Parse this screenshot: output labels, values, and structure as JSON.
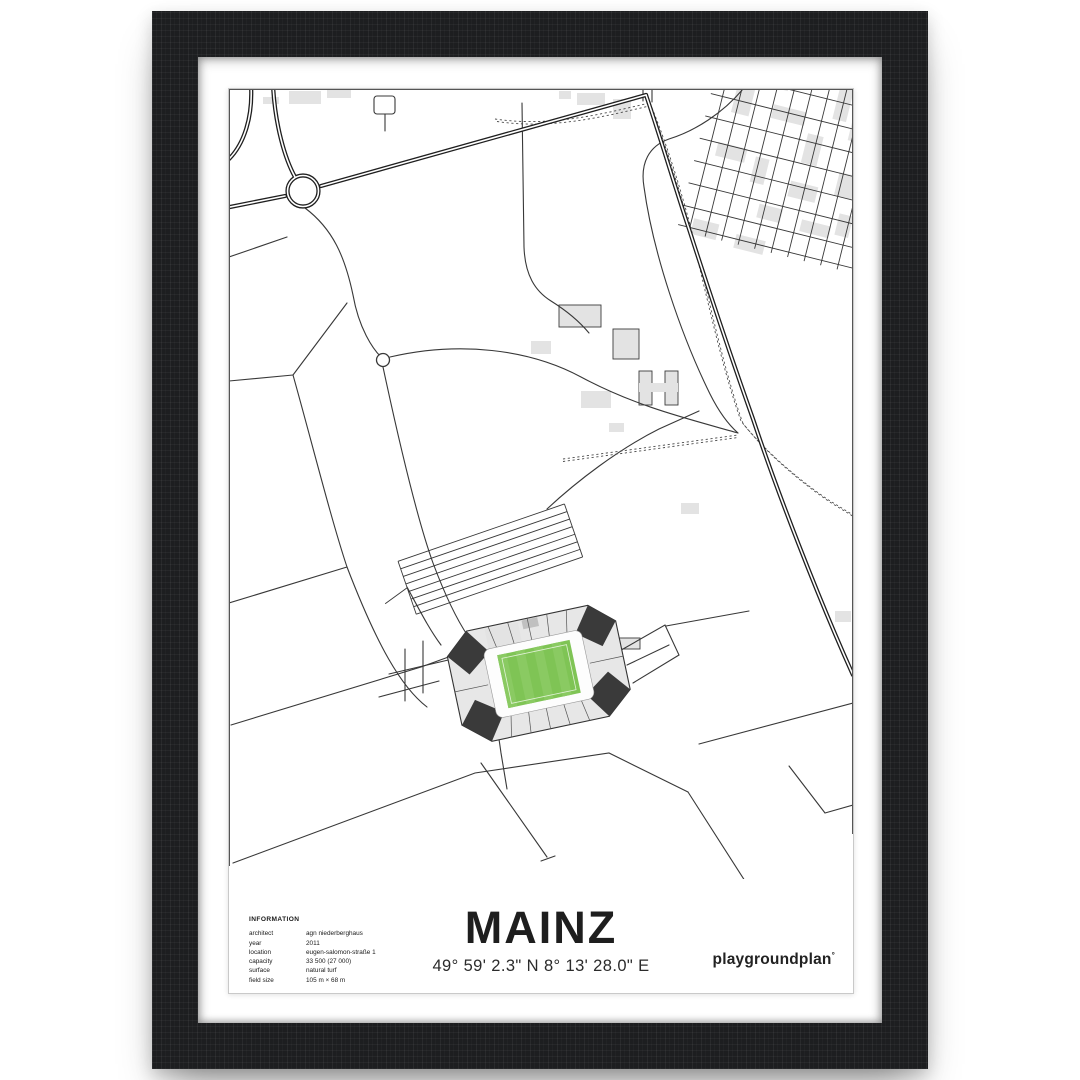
{
  "poster": {
    "title": "MAINZ",
    "coordinates": "49° 59' 2.3\" N  8° 13' 28.0\" E",
    "brand": "playgroundplan",
    "brand_mark": "°"
  },
  "info": {
    "header": "INFORMATION",
    "rows": [
      {
        "label": "architect",
        "value": "agn niederberghaus"
      },
      {
        "label": "year",
        "value": "2011"
      },
      {
        "label": "location",
        "value": "eugen-salomon-straße 1"
      },
      {
        "label": "capacity",
        "value": "33 500 (27 000)"
      },
      {
        "label": "surface",
        "value": "natural turf"
      },
      {
        "label": "field size",
        "value": "105 m × 68 m"
      }
    ]
  },
  "map": {
    "features": [
      "roundabout",
      "main-road",
      "street-grid",
      "stadium",
      "parking-rows",
      "footpath-dashed",
      "mini-roundabout"
    ]
  },
  "colors": {
    "frame": "#1d1e20",
    "road": "#383838",
    "road-heavy": "#1f1f1f",
    "building": "#e3e3e3",
    "corner-dark": "#3a3a3a",
    "pitch-green": "#7fc455",
    "pitch-stripe": "#8aca62",
    "text": "#1c1c1c"
  }
}
